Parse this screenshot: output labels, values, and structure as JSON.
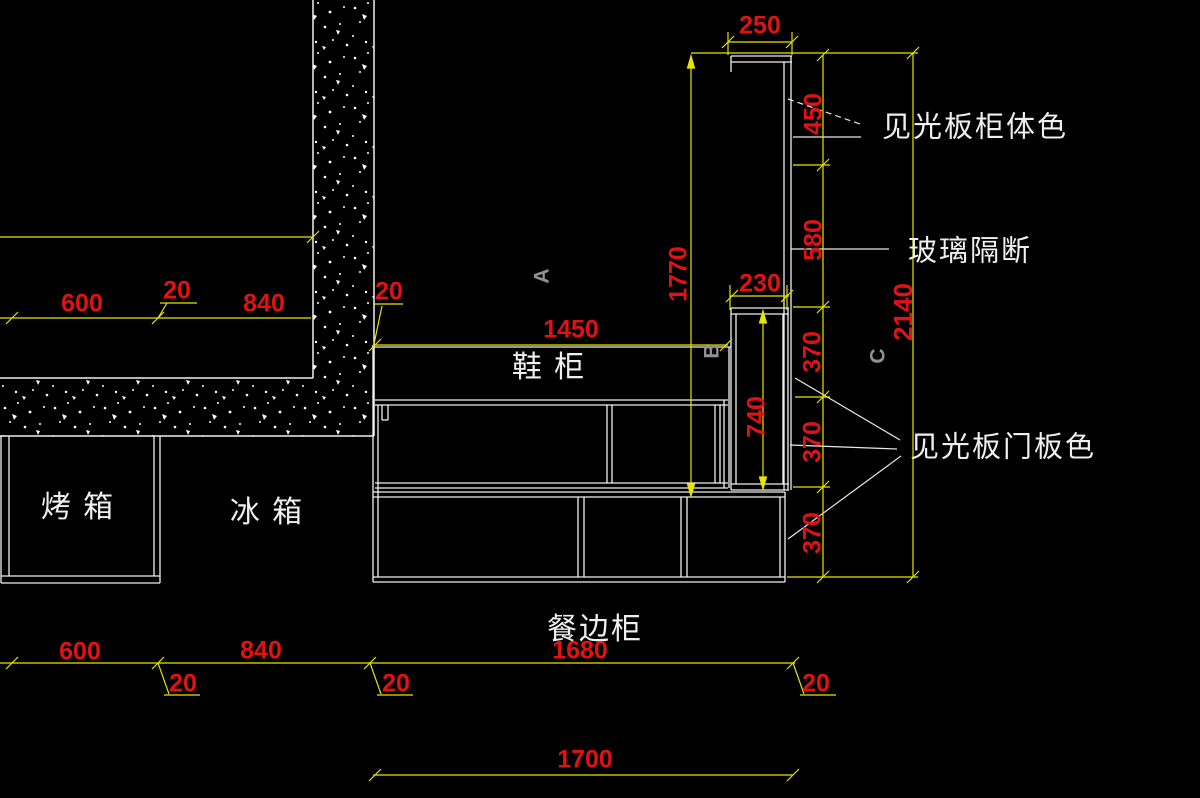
{
  "labels": {
    "cabinet_body_color": "见光板柜体色",
    "glass_partition": "玻璃隔断",
    "door_panel_color": "见光板门板色",
    "shoe_cabinet": "鞋 柜",
    "oven": "烤 箱",
    "fridge": "冰 箱",
    "sideboard": "餐边柜"
  },
  "letters": {
    "a": "A",
    "b": "B",
    "c": "C"
  },
  "dims": {
    "d250": "250",
    "d450": "450",
    "d580": "580",
    "d2140": "2140",
    "d1770": "1770",
    "d230": "230",
    "d740": "740",
    "d370": "370",
    "d1450": "1450",
    "d600": "600",
    "d20": "20",
    "d840": "840",
    "d1680": "1680",
    "d1700": "1700"
  },
  "colors": {
    "background": "#000000",
    "drawing_line": "#f0f0f0",
    "dimension_line": "#e5e500",
    "dimension_text": "#e01212",
    "section_letter": "#929292"
  }
}
